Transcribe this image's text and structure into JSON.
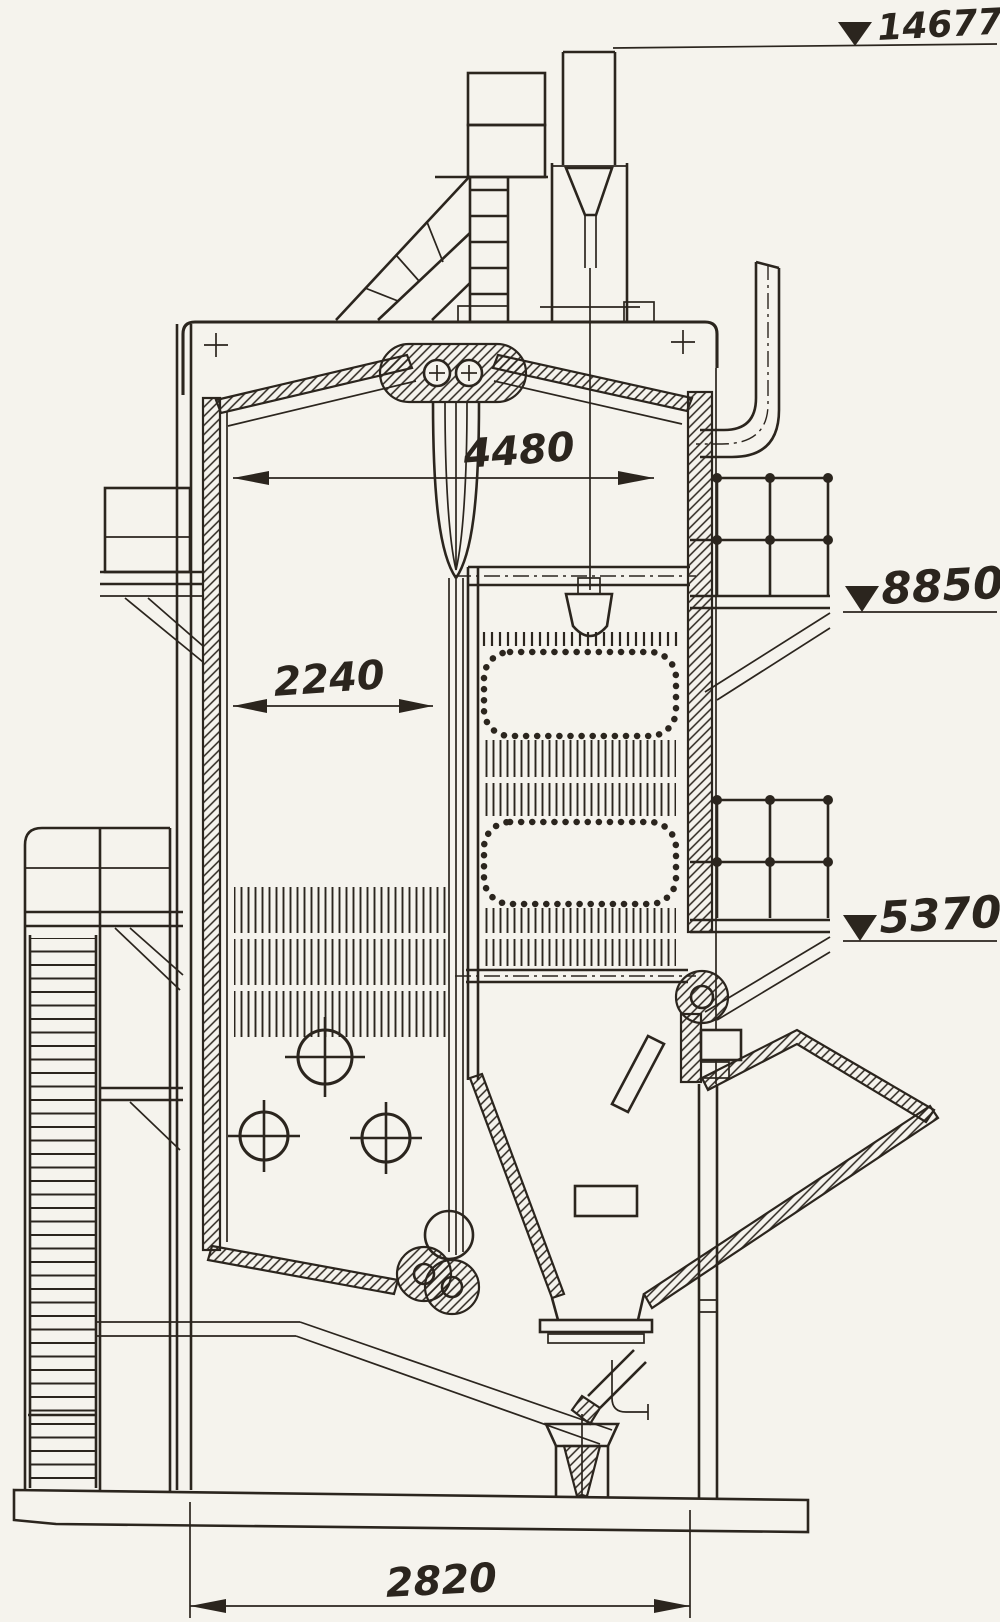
{
  "drawing": {
    "type": "boiler-sectional-elevation",
    "elevation_marks": [
      {
        "name": "stack-top-elevation",
        "label": "14677"
      },
      {
        "name": "upper-platform-elevation",
        "label": "8850"
      },
      {
        "name": "lower-platform-elevation",
        "label": "5370"
      }
    ],
    "dimensions": [
      {
        "name": "interior-overall-width",
        "label": "4480"
      },
      {
        "name": "furnace-width",
        "label": "2240"
      },
      {
        "name": "base-width",
        "label": "2820"
      }
    ],
    "colors": {
      "ink": "#2b251e",
      "paper": "#f5f3ed"
    }
  }
}
